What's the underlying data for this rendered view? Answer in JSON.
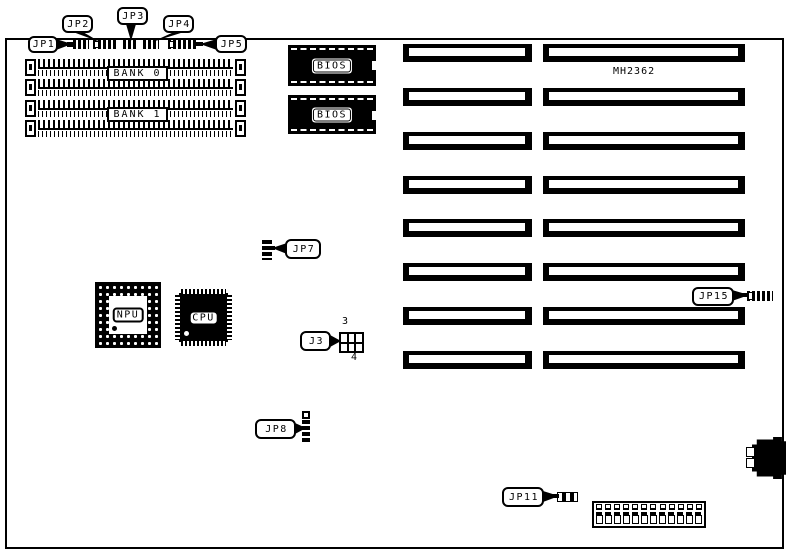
{
  "board": {
    "model_label": "MH2362"
  },
  "callouts": {
    "jp1": "JP1",
    "jp2": "JP2",
    "jp3": "JP3",
    "jp4": "JP4",
    "jp5": "JP5",
    "jp7": "JP7",
    "j3": "J3",
    "jp8": "JP8",
    "jp11": "JP11",
    "jp15": "JP15"
  },
  "pin_labels": {
    "j3_top": "3",
    "j3_bottom": "4"
  },
  "memory": {
    "bank0_label": "BANK 0",
    "bank1_label": "BANK 1",
    "simm_rows": 4
  },
  "chips": {
    "bios_label": "BIOS",
    "bios_count": 2,
    "npu_label": "NPU",
    "cpu_label": "CPU"
  },
  "slots": {
    "rows": 8,
    "columns": 2
  },
  "connectors": {
    "power_top_pins": 12,
    "power_bottom_pins": 12
  },
  "colors": {
    "ink": "#000000",
    "background": "#ffffff"
  }
}
